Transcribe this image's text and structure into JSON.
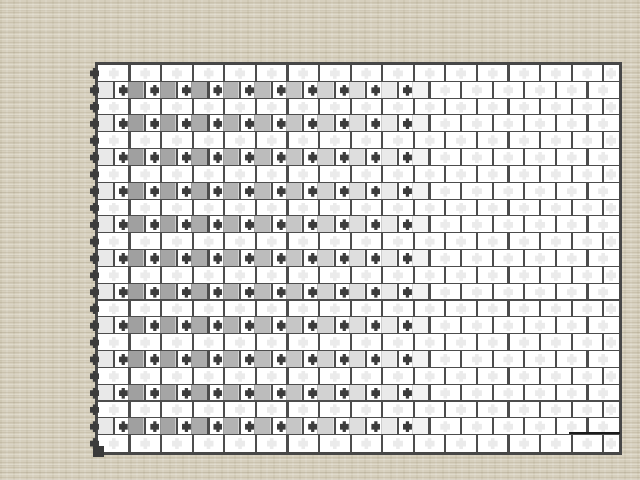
{
  "desktop": {
    "background_base": "#d6cfbd"
  },
  "board": {
    "left": 95,
    "top": 62,
    "width": 527,
    "height": 393,
    "frame_thickness": 3,
    "frame_color": "#474747",
    "line_color": "#4d4d4d",
    "line_thickness": 2.2,
    "brick_color": "#ffffff",
    "rows": 23,
    "bricks_per_plain_row": 17,
    "bricks_per_pattern_row": 16,
    "pattern_rows_are": "even rows (2,4,...,22)",
    "leading_half_brick_color": "#e9e9e9",
    "faint_glyph_color": "#ebebeb",
    "dark_glyph_color": "#3c3c3c",
    "active_cells_per_pattern_row": 10,
    "active_fill_colors": [
      "#a0a0a0",
      "#a5a5a5",
      "#ababab",
      "#b3b3b3",
      "#bcbcbc",
      "#c6c6c6",
      "#d2d2d2",
      "#dedede",
      "#eaeaea",
      "#f3f3f3"
    ],
    "edge_markers": {
      "count": 23,
      "color": "#3c3c3c"
    },
    "scale_line": {
      "x1": 569,
      "x2": 620,
      "y": 432,
      "thickness": 2,
      "color": "#1c1c1c"
    },
    "corner_handle": {
      "x": 93,
      "y": 446,
      "size": 11,
      "color": "#3a3a3a"
    }
  }
}
